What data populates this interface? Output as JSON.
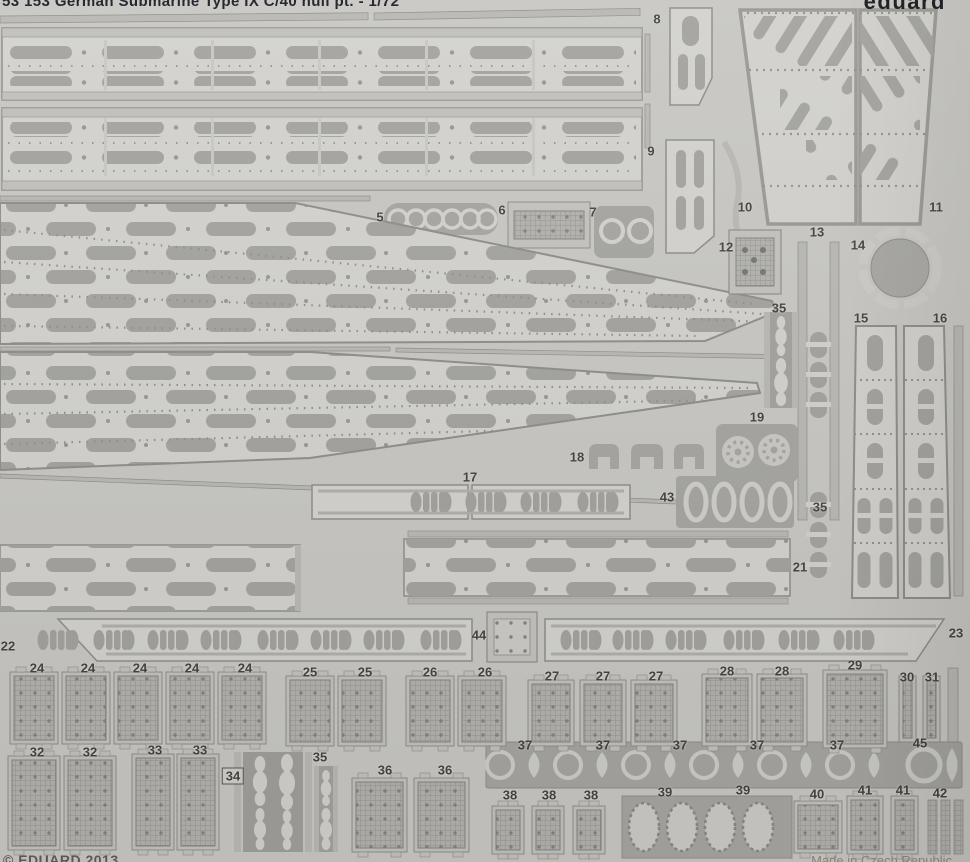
{
  "header": {
    "title": "53 153  German Submarine Type IX C/40 hull pt.  -  1/72",
    "brand": "eduard"
  },
  "footer": {
    "copyright": "© EDUARD 2013",
    "origin": "Made in Czech Republic"
  },
  "colors": {
    "background": "#c8c7c3",
    "plate": "#d3d2ce",
    "feature_gray": "#a4a39f",
    "dark_plate": "#a6a5a1",
    "rail": "#b9b8b3",
    "edge": "#8f8e89",
    "title_ink": "#1c1c27",
    "label_ink": "#45443f"
  },
  "part_labels": [
    {
      "text": "5",
      "x": 380,
      "y": 217
    },
    {
      "text": "6",
      "x": 502,
      "y": 210
    },
    {
      "text": "7",
      "x": 593,
      "y": 212
    },
    {
      "text": "8",
      "x": 657,
      "y": 19
    },
    {
      "text": "9",
      "x": 651,
      "y": 151
    },
    {
      "text": "10",
      "x": 745,
      "y": 207
    },
    {
      "text": "11",
      "x": 936,
      "y": 207
    },
    {
      "text": "12",
      "x": 726,
      "y": 247
    },
    {
      "text": "13",
      "x": 817,
      "y": 232
    },
    {
      "text": "14",
      "x": 858,
      "y": 245
    },
    {
      "text": "35",
      "x": 779,
      "y": 308
    },
    {
      "text": "15",
      "x": 861,
      "y": 318
    },
    {
      "text": "16",
      "x": 940,
      "y": 318
    },
    {
      "text": "19",
      "x": 757,
      "y": 417
    },
    {
      "text": "18",
      "x": 577,
      "y": 457
    },
    {
      "text": "17",
      "x": 470,
      "y": 477
    },
    {
      "text": "43",
      "x": 667,
      "y": 497
    },
    {
      "text": "35",
      "x": 820,
      "y": 507
    },
    {
      "text": "21",
      "x": 800,
      "y": 567
    },
    {
      "text": "22",
      "x": 8,
      "y": 646
    },
    {
      "text": "44",
      "x": 479,
      "y": 635
    },
    {
      "text": "23",
      "x": 956,
      "y": 633
    },
    {
      "text": "24",
      "x": 37,
      "y": 668
    },
    {
      "text": "24",
      "x": 88,
      "y": 668
    },
    {
      "text": "24",
      "x": 140,
      "y": 668
    },
    {
      "text": "24",
      "x": 192,
      "y": 668
    },
    {
      "text": "24",
      "x": 245,
      "y": 668
    },
    {
      "text": "25",
      "x": 310,
      "y": 672
    },
    {
      "text": "25",
      "x": 365,
      "y": 672
    },
    {
      "text": "26",
      "x": 430,
      "y": 672
    },
    {
      "text": "26",
      "x": 485,
      "y": 672
    },
    {
      "text": "27",
      "x": 552,
      "y": 676
    },
    {
      "text": "27",
      "x": 603,
      "y": 676
    },
    {
      "text": "27",
      "x": 656,
      "y": 676
    },
    {
      "text": "28",
      "x": 727,
      "y": 671
    },
    {
      "text": "28",
      "x": 782,
      "y": 671
    },
    {
      "text": "29",
      "x": 855,
      "y": 665
    },
    {
      "text": "30",
      "x": 907,
      "y": 677
    },
    {
      "text": "31",
      "x": 932,
      "y": 677
    },
    {
      "text": "32",
      "x": 37,
      "y": 752
    },
    {
      "text": "32",
      "x": 90,
      "y": 752
    },
    {
      "text": "33",
      "x": 155,
      "y": 750
    },
    {
      "text": "33",
      "x": 200,
      "y": 750
    },
    {
      "text": "34",
      "x": 233,
      "y": 776,
      "boxed": true
    },
    {
      "text": "35",
      "x": 320,
      "y": 757
    },
    {
      "text": "36",
      "x": 385,
      "y": 770
    },
    {
      "text": "36",
      "x": 445,
      "y": 770
    },
    {
      "text": "37",
      "x": 525,
      "y": 745
    },
    {
      "text": "37",
      "x": 603,
      "y": 745
    },
    {
      "text": "37",
      "x": 680,
      "y": 745
    },
    {
      "text": "37",
      "x": 757,
      "y": 745
    },
    {
      "text": "37",
      "x": 837,
      "y": 745
    },
    {
      "text": "45",
      "x": 920,
      "y": 743
    },
    {
      "text": "38",
      "x": 510,
      "y": 795
    },
    {
      "text": "38",
      "x": 549,
      "y": 795
    },
    {
      "text": "38",
      "x": 591,
      "y": 795
    },
    {
      "text": "39",
      "x": 665,
      "y": 792
    },
    {
      "text": "39",
      "x": 743,
      "y": 790
    },
    {
      "text": "40",
      "x": 817,
      "y": 794
    },
    {
      "text": "41",
      "x": 865,
      "y": 790
    },
    {
      "text": "41",
      "x": 903,
      "y": 790
    },
    {
      "text": "42",
      "x": 940,
      "y": 793
    }
  ]
}
